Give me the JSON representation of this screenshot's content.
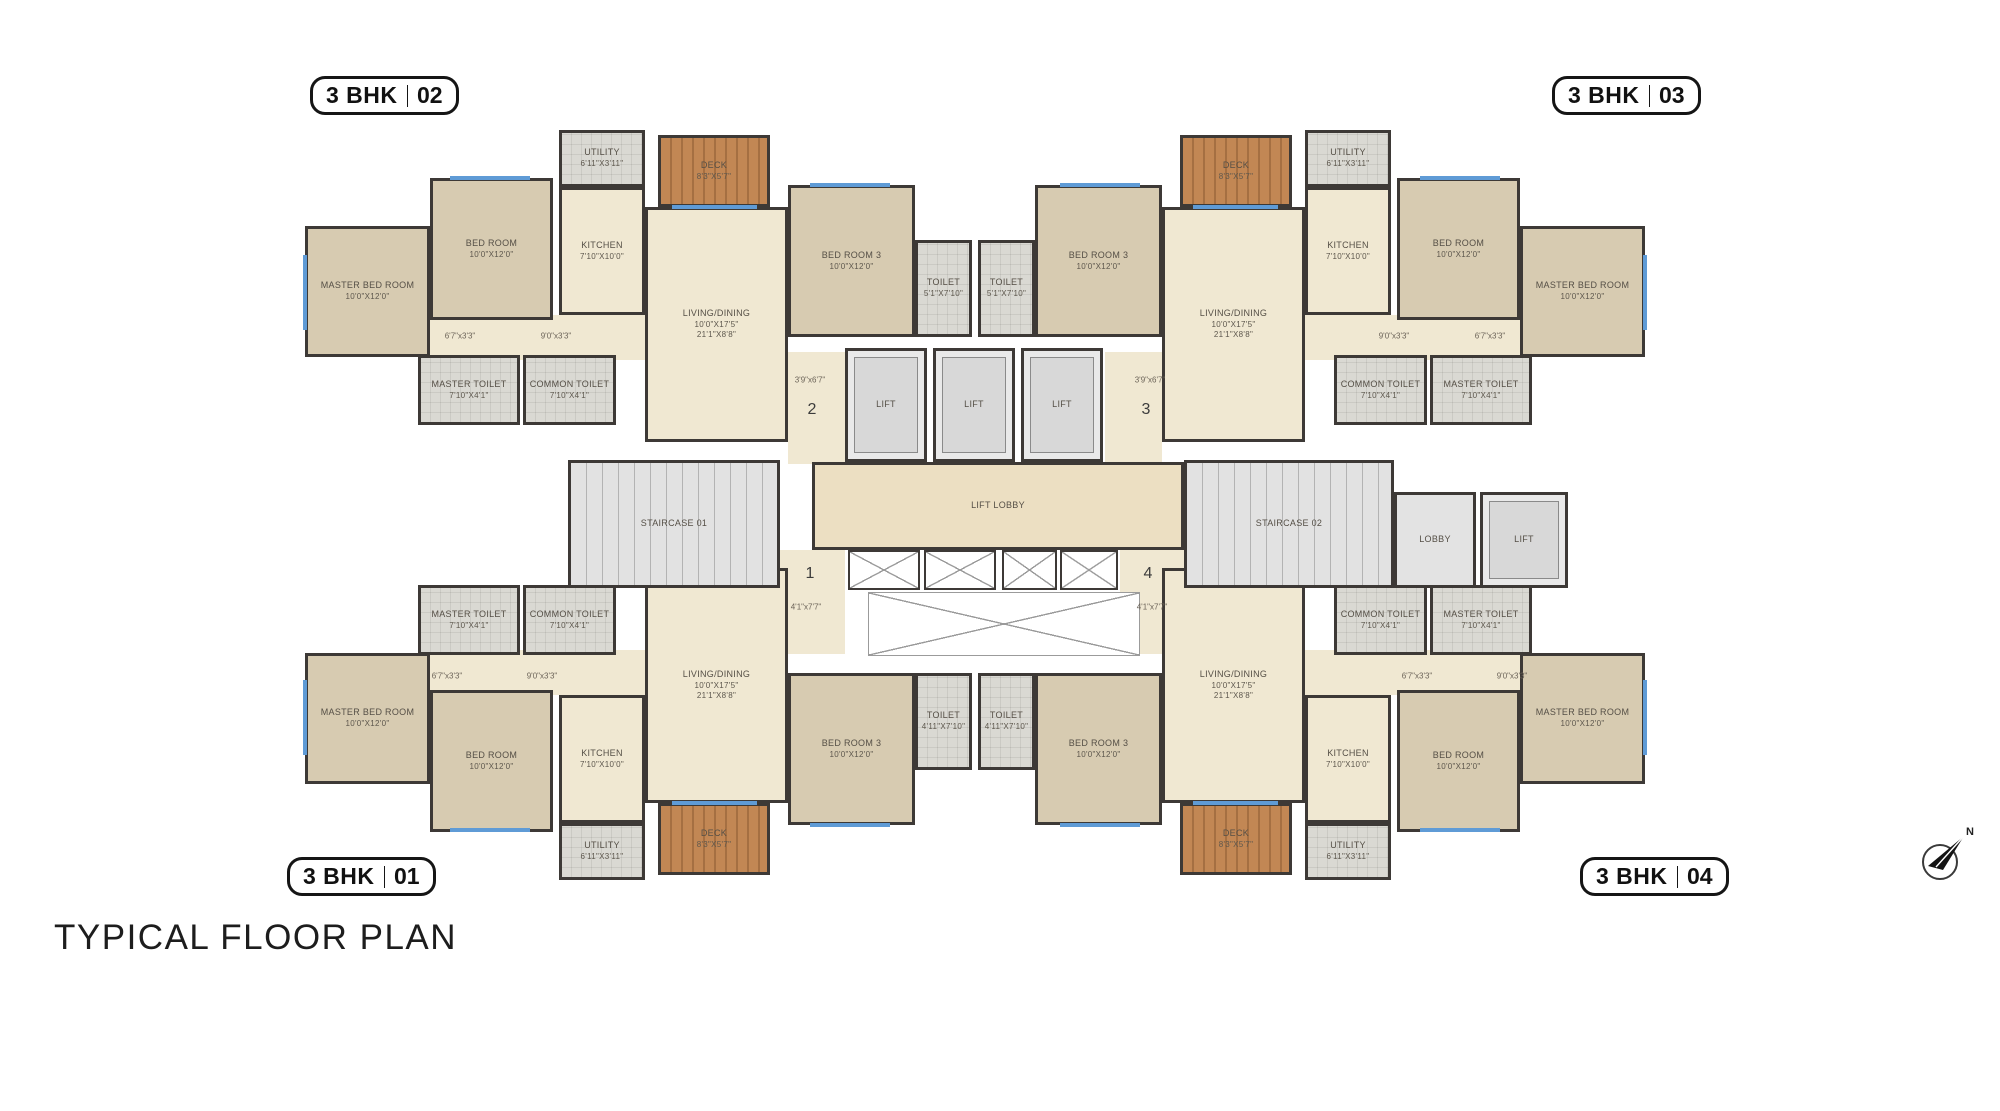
{
  "title": "TYPICAL FLOOR PLAN",
  "north_label": "N",
  "badge_02": {
    "bhk": "3 BHK",
    "num": "02"
  },
  "badge_03": {
    "bhk": "3 BHK",
    "num": "03"
  },
  "badge_01": {
    "bhk": "3 BHK",
    "num": "01"
  },
  "badge_04": {
    "bhk": "3 BHK",
    "num": "04"
  },
  "colors": {
    "wall": "#3d3936",
    "floor_cream": "#f0e8d2",
    "floor_bedroom_tan": "#d7cbb1",
    "floor_tile": "#dad9d3",
    "deck_wood": "#c28754",
    "stairs_gray": "#e2e2e2",
    "window_blue": "#5f9bd6",
    "badge_black": "#151515"
  },
  "rooms": [
    {
      "id": "02-passage",
      "floor": "cream",
      "open": true,
      "x": 430,
      "y": 315,
      "w": 218,
      "h": 45
    },
    {
      "id": "03-passage",
      "floor": "cream",
      "open": true,
      "x": 1302,
      "y": 315,
      "w": 218,
      "h": 45
    },
    {
      "id": "01-passage",
      "floor": "cream",
      "open": true,
      "x": 430,
      "y": 650,
      "w": 218,
      "h": 45
    },
    {
      "id": "04-passage",
      "floor": "cream",
      "open": true,
      "x": 1302,
      "y": 650,
      "w": 218,
      "h": 45
    },
    {
      "id": "entry-foyer-2",
      "floor": "cream",
      "open": true,
      "x": 788,
      "y": 352,
      "w": 57,
      "h": 112
    },
    {
      "id": "entry-foyer-3",
      "floor": "cream",
      "open": true,
      "x": 1105,
      "y": 352,
      "w": 57,
      "h": 112
    },
    {
      "id": "entry-foyer-1",
      "floor": "cream",
      "open": true,
      "x": 778,
      "y": 550,
      "w": 67,
      "h": 104
    },
    {
      "id": "entry-foyer-4",
      "floor": "cream",
      "open": true,
      "x": 1120,
      "y": 550,
      "w": 68,
      "h": 104
    },
    {
      "id": "02-master-bed-room",
      "label": "MASTER BED ROOM",
      "dims": [
        "10'0\"X12'0\""
      ],
      "floor": "tan",
      "x": 305,
      "y": 226,
      "w": 125,
      "h": 131
    },
    {
      "id": "02-bed-room",
      "label": "BED ROOM",
      "dims": [
        "10'0\"X12'0\""
      ],
      "floor": "tan",
      "x": 430,
      "y": 178,
      "w": 123,
      "h": 142
    },
    {
      "id": "02-utility",
      "label": "UTILITY",
      "dims": [
        "6'11\"X3'11\""
      ],
      "floor": "tile",
      "x": 559,
      "y": 130,
      "w": 86,
      "h": 57
    },
    {
      "id": "02-deck",
      "label": "DECK",
      "dims": [
        "8'3\"X5'7\""
      ],
      "floor": "wood",
      "x": 658,
      "y": 135,
      "w": 112,
      "h": 72
    },
    {
      "id": "02-kitchen",
      "label": "KITCHEN",
      "dims": [
        "7'10\"X10'0\""
      ],
      "floor": "cream",
      "x": 559,
      "y": 187,
      "w": 86,
      "h": 128
    },
    {
      "id": "02-living-dining",
      "label": "LIVING/DINING",
      "dims": [
        "10'0\"X17'5\"",
        "21'1\"X8'8\""
      ],
      "floor": "cream",
      "x": 645,
      "y": 207,
      "w": 143,
      "h": 235
    },
    {
      "id": "02-bed-room-3",
      "label": "BED ROOM 3",
      "dims": [
        "10'0\"X12'0\""
      ],
      "floor": "tan",
      "x": 788,
      "y": 185,
      "w": 127,
      "h": 152
    },
    {
      "id": "02-toilet",
      "label": "TOILET",
      "dims": [
        "5'1\"X7'10\""
      ],
      "floor": "tile",
      "x": 915,
      "y": 240,
      "w": 57,
      "h": 97
    },
    {
      "id": "02-master-toilet",
      "label": "MASTER TOILET",
      "dims": [
        "7'10\"X4'1\""
      ],
      "floor": "tile",
      "x": 418,
      "y": 355,
      "w": 102,
      "h": 70
    },
    {
      "id": "02-common-toilet",
      "label": "COMMON TOILET",
      "dims": [
        "7'10\"X4'1\""
      ],
      "floor": "tile",
      "x": 523,
      "y": 355,
      "w": 93,
      "h": 70
    },
    {
      "id": "03-master-bed-room",
      "label": "MASTER BED ROOM",
      "dims": [
        "10'0\"X12'0\""
      ],
      "floor": "tan",
      "x": 1520,
      "y": 226,
      "w": 125,
      "h": 131
    },
    {
      "id": "03-bed-room",
      "label": "BED ROOM",
      "dims": [
        "10'0\"X12'0\""
      ],
      "floor": "tan",
      "x": 1397,
      "y": 178,
      "w": 123,
      "h": 142
    },
    {
      "id": "03-utility",
      "label": "UTILITY",
      "dims": [
        "6'11\"X3'11\""
      ],
      "floor": "tile",
      "x": 1305,
      "y": 130,
      "w": 86,
      "h": 57
    },
    {
      "id": "03-deck",
      "label": "DECK",
      "dims": [
        "8'3\"X5'7\""
      ],
      "floor": "wood",
      "x": 1180,
      "y": 135,
      "w": 112,
      "h": 72
    },
    {
      "id": "03-kitchen",
      "label": "KITCHEN",
      "dims": [
        "7'10\"X10'0\""
      ],
      "floor": "cream",
      "x": 1305,
      "y": 187,
      "w": 86,
      "h": 128
    },
    {
      "id": "03-living-dining",
      "label": "LIVING/DINING",
      "dims": [
        "10'0\"X17'5\"",
        "21'1\"X8'8\""
      ],
      "floor": "cream",
      "x": 1162,
      "y": 207,
      "w": 143,
      "h": 235
    },
    {
      "id": "03-bed-room-3",
      "label": "BED ROOM 3",
      "dims": [
        "10'0\"X12'0\""
      ],
      "floor": "tan",
      "x": 1035,
      "y": 185,
      "w": 127,
      "h": 152
    },
    {
      "id": "03-toilet",
      "label": "TOILET",
      "dims": [
        "5'1\"X7'10\""
      ],
      "floor": "tile",
      "x": 978,
      "y": 240,
      "w": 57,
      "h": 97
    },
    {
      "id": "03-master-toilet",
      "label": "MASTER TOILET",
      "dims": [
        "7'10\"X4'1\""
      ],
      "floor": "tile",
      "x": 1430,
      "y": 355,
      "w": 102,
      "h": 70
    },
    {
      "id": "03-common-toilet",
      "label": "COMMON TOILET",
      "dims": [
        "7'10\"X4'1\""
      ],
      "floor": "tile",
      "x": 1334,
      "y": 355,
      "w": 93,
      "h": 70
    },
    {
      "id": "01-master-bed-room",
      "label": "MASTER BED ROOM",
      "dims": [
        "10'0\"X12'0\""
      ],
      "floor": "tan",
      "x": 305,
      "y": 653,
      "w": 125,
      "h": 131
    },
    {
      "id": "01-bed-room",
      "label": "BED ROOM",
      "dims": [
        "10'0\"X12'0\""
      ],
      "floor": "tan",
      "x": 430,
      "y": 690,
      "w": 123,
      "h": 142
    },
    {
      "id": "01-utility",
      "label": "UTILITY",
      "dims": [
        "6'11\"X3'11\""
      ],
      "floor": "tile",
      "x": 559,
      "y": 823,
      "w": 86,
      "h": 57
    },
    {
      "id": "01-deck",
      "label": "DECK",
      "dims": [
        "8'3\"X5'7\""
      ],
      "floor": "wood",
      "x": 658,
      "y": 803,
      "w": 112,
      "h": 72
    },
    {
      "id": "01-kitchen",
      "label": "KITCHEN",
      "dims": [
        "7'10\"X10'0\""
      ],
      "floor": "cream",
      "x": 559,
      "y": 695,
      "w": 86,
      "h": 128
    },
    {
      "id": "01-living-dining",
      "label": "LIVING/DINING",
      "dims": [
        "10'0\"X17'5\"",
        "21'1\"X8'8\""
      ],
      "floor": "cream",
      "x": 645,
      "y": 568,
      "w": 143,
      "h": 235
    },
    {
      "id": "01-bed-room-3",
      "label": "BED ROOM 3",
      "dims": [
        "10'0\"X12'0\""
      ],
      "floor": "tan",
      "x": 788,
      "y": 673,
      "w": 127,
      "h": 152
    },
    {
      "id": "01-toilet",
      "label": "TOILET",
      "dims": [
        "4'11\"X7'10\""
      ],
      "floor": "tile",
      "x": 915,
      "y": 673,
      "w": 57,
      "h": 97
    },
    {
      "id": "01-master-toilet",
      "label": "MASTER TOILET",
      "dims": [
        "7'10\"X4'1\""
      ],
      "floor": "tile",
      "x": 418,
      "y": 585,
      "w": 102,
      "h": 70
    },
    {
      "id": "01-common-toilet",
      "label": "COMMON TOILET",
      "dims": [
        "7'10\"X4'1\""
      ],
      "floor": "tile",
      "x": 523,
      "y": 585,
      "w": 93,
      "h": 70
    },
    {
      "id": "04-master-bed-room",
      "label": "MASTER BED ROOM",
      "dims": [
        "10'0\"X12'0\""
      ],
      "floor": "tan",
      "x": 1520,
      "y": 653,
      "w": 125,
      "h": 131
    },
    {
      "id": "04-bed-room",
      "label": "BED ROOM",
      "dims": [
        "10'0\"X12'0\""
      ],
      "floor": "tan",
      "x": 1397,
      "y": 690,
      "w": 123,
      "h": 142
    },
    {
      "id": "04-utility",
      "label": "UTILITY",
      "dims": [
        "6'11\"X3'11\""
      ],
      "floor": "tile",
      "x": 1305,
      "y": 823,
      "w": 86,
      "h": 57
    },
    {
      "id": "04-deck",
      "label": "DECK",
      "dims": [
        "8'3\"X5'7\""
      ],
      "floor": "wood",
      "x": 1180,
      "y": 803,
      "w": 112,
      "h": 72
    },
    {
      "id": "04-kitchen",
      "label": "KITCHEN",
      "dims": [
        "7'10\"X10'0\""
      ],
      "floor": "cream",
      "x": 1305,
      "y": 695,
      "w": 86,
      "h": 128
    },
    {
      "id": "04-living-dining",
      "label": "LIVING/DINING",
      "dims": [
        "10'0\"X17'5\"",
        "21'1\"X8'8\""
      ],
      "floor": "cream",
      "x": 1162,
      "y": 568,
      "w": 143,
      "h": 235
    },
    {
      "id": "04-bed-room-3",
      "label": "BED ROOM 3",
      "dims": [
        "10'0\"X12'0\""
      ],
      "floor": "tan",
      "x": 1035,
      "y": 673,
      "w": 127,
      "h": 152
    },
    {
      "id": "04-toilet",
      "label": "TOILET",
      "dims": [
        "4'11\"X7'10\""
      ],
      "floor": "tile",
      "x": 978,
      "y": 673,
      "w": 57,
      "h": 97
    },
    {
      "id": "04-master-toilet",
      "label": "MASTER TOILET",
      "dims": [
        "7'10\"X4'1\""
      ],
      "floor": "tile",
      "x": 1430,
      "y": 585,
      "w": 102,
      "h": 70
    },
    {
      "id": "04-common-toilet",
      "label": "COMMON TOILET",
      "dims": [
        "7'10\"X4'1\""
      ],
      "floor": "tile",
      "x": 1334,
      "y": 585,
      "w": 93,
      "h": 70
    },
    {
      "id": "lift-lobby",
      "label": "LIFT LOBBY",
      "floor": "lobby",
      "x": 812,
      "y": 462,
      "w": 372,
      "h": 88
    },
    {
      "id": "lift-1",
      "label": "LIFT",
      "floor": "lift",
      "x": 845,
      "y": 348,
      "w": 82,
      "h": 114
    },
    {
      "id": "lift-2",
      "label": "LIFT",
      "floor": "lift",
      "x": 933,
      "y": 348,
      "w": 82,
      "h": 114
    },
    {
      "id": "lift-3",
      "label": "LIFT",
      "floor": "lift",
      "x": 1021,
      "y": 348,
      "w": 82,
      "h": 114
    },
    {
      "id": "staircase-01",
      "label": "STAIRCASE 01",
      "floor": "stairs",
      "x": 568,
      "y": 460,
      "w": 212,
      "h": 128
    },
    {
      "id": "staircase-02",
      "label": "STAIRCASE 02",
      "floor": "stairs",
      "x": 1184,
      "y": 460,
      "w": 210,
      "h": 128
    },
    {
      "id": "lobby",
      "label": "LOBBY",
      "floor": "gray",
      "x": 1394,
      "y": 492,
      "w": 82,
      "h": 96
    },
    {
      "id": "lift-4",
      "label": "LIFT",
      "floor": "lift",
      "x": 1480,
      "y": 492,
      "w": 88,
      "h": 96
    }
  ],
  "windows": [
    {
      "x": 303,
      "y": 255,
      "w": 4,
      "h": 75
    },
    {
      "x": 450,
      "y": 176,
      "w": 80,
      "h": 4
    },
    {
      "x": 810,
      "y": 183,
      "w": 80,
      "h": 4
    },
    {
      "x": 672,
      "y": 205,
      "w": 85,
      "h": 4
    },
    {
      "x": 1643,
      "y": 255,
      "w": 4,
      "h": 75
    },
    {
      "x": 1420,
      "y": 176,
      "w": 80,
      "h": 4
    },
    {
      "x": 1060,
      "y": 183,
      "w": 80,
      "h": 4
    },
    {
      "x": 1193,
      "y": 205,
      "w": 85,
      "h": 4
    },
    {
      "x": 303,
      "y": 680,
      "w": 4,
      "h": 75
    },
    {
      "x": 450,
      "y": 828,
      "w": 80,
      "h": 4
    },
    {
      "x": 810,
      "y": 823,
      "w": 80,
      "h": 4
    },
    {
      "x": 672,
      "y": 801,
      "w": 85,
      "h": 4
    },
    {
      "x": 1643,
      "y": 680,
      "w": 4,
      "h": 75
    },
    {
      "x": 1420,
      "y": 828,
      "w": 80,
      "h": 4
    },
    {
      "x": 1060,
      "y": 823,
      "w": 80,
      "h": 4
    },
    {
      "x": 1193,
      "y": 801,
      "w": 85,
      "h": 4
    }
  ],
  "shafts": [
    {
      "x": 848,
      "y": 550,
      "w": 72,
      "h": 40
    },
    {
      "x": 924,
      "y": 550,
      "w": 72,
      "h": 40
    },
    {
      "x": 1002,
      "y": 550,
      "w": 55,
      "h": 40
    },
    {
      "x": 1060,
      "y": 550,
      "w": 58,
      "h": 40
    },
    {
      "x": 868,
      "y": 592,
      "w": 272,
      "h": 64,
      "light": true
    }
  ],
  "annotations": [
    {
      "text": "6'7\"x3'3\"",
      "x": 460,
      "y": 336
    },
    {
      "text": "9'0\"x3'3\"",
      "x": 556,
      "y": 336
    },
    {
      "text": "3'9\"x6'7\"",
      "x": 810,
      "y": 380
    },
    {
      "text": "9'0\"x3'3\"",
      "x": 1394,
      "y": 336
    },
    {
      "text": "6'7\"x3'3\"",
      "x": 1490,
      "y": 336
    },
    {
      "text": "3'9\"x6'7\"",
      "x": 1150,
      "y": 380
    },
    {
      "text": "4'1\"x7'7\"",
      "x": 806,
      "y": 607
    },
    {
      "text": "4'1\"x7'7\"",
      "x": 1152,
      "y": 607
    },
    {
      "text": "6'7\"x3'3\"",
      "x": 447,
      "y": 676
    },
    {
      "text": "9'0\"x3'3\"",
      "x": 542,
      "y": 676
    },
    {
      "text": "6'7\"x3'3\"",
      "x": 1417,
      "y": 676
    },
    {
      "text": "9'0\"x3'3\"",
      "x": 1512,
      "y": 676
    }
  ],
  "entry_numbers": [
    {
      "text": "2",
      "x": 812,
      "y": 410
    },
    {
      "text": "3",
      "x": 1146,
      "y": 410
    },
    {
      "text": "1",
      "x": 810,
      "y": 574
    },
    {
      "text": "4",
      "x": 1148,
      "y": 574
    }
  ]
}
